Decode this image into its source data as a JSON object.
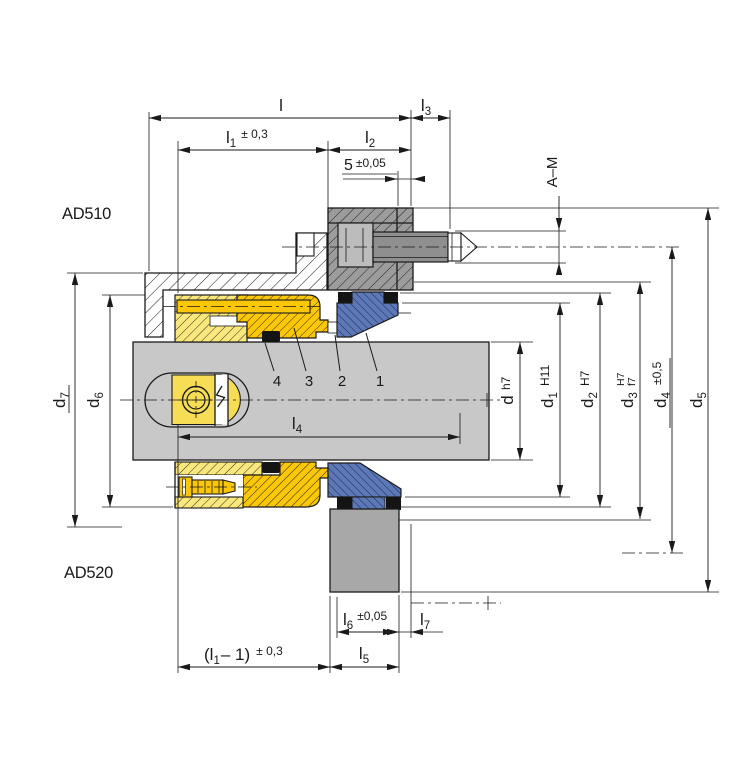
{
  "drawing": {
    "title_hidden": false,
    "variant_labels": {
      "top": "AD510",
      "bottom": "AD520"
    },
    "part_numbers": [
      "4",
      "3",
      "2",
      "1"
    ],
    "dimensions": {
      "l": {
        "base": "l"
      },
      "l1": {
        "base": "l",
        "sub": "1",
        "tol": "± 0,3"
      },
      "l2": {
        "base": "l",
        "sub": "2"
      },
      "l3": {
        "base": "l",
        "sub": "3"
      },
      "l4": {
        "base": "l",
        "sub": "4"
      },
      "l5": {
        "base": "l",
        "sub": "5"
      },
      "l6": {
        "base": "l",
        "sub": "6",
        "tol": "±0,05"
      },
      "l7": {
        "base": "l",
        "sub": "7"
      },
      "l1_minus_1": {
        "base": "(l",
        "sub": "1",
        "rest": "– 1)",
        "tol": "± 0,3"
      },
      "five": {
        "base": "5",
        "tol": "±0,05"
      },
      "a_m": {
        "base": "A–M"
      },
      "d": {
        "base": "d",
        "tol": "h7"
      },
      "d1": {
        "base": "d",
        "sub": "1",
        "tol": "H11"
      },
      "d2": {
        "base": "d",
        "sub": "2",
        "tol": "H7"
      },
      "d3": {
        "base": "d",
        "sub": "3",
        "tol_upper": "H7",
        "tol_lower": "f7"
      },
      "d4": {
        "base": "d",
        "sub": "4",
        "tol": "±0,5"
      },
      "d5": {
        "base": "d",
        "sub": "5"
      },
      "d6": {
        "base": "d",
        "sub": "6"
      },
      "d7": {
        "base": "d",
        "sub": "7"
      }
    },
    "colors": {
      "line": "#1a1a1a",
      "shaft_gray": "#c8c8c8",
      "clamp_gray": "#9c9c9c",
      "screw_gray": "#8f8f8f",
      "recess_gray": "#bcbcbc",
      "housing_block_gray": "#a8a8a8",
      "seal_light_yellow": "#fbe87c",
      "seal_gold": "#fbc707",
      "seat_blue": "#5d78b6",
      "oring_black": "#141414"
    }
  }
}
